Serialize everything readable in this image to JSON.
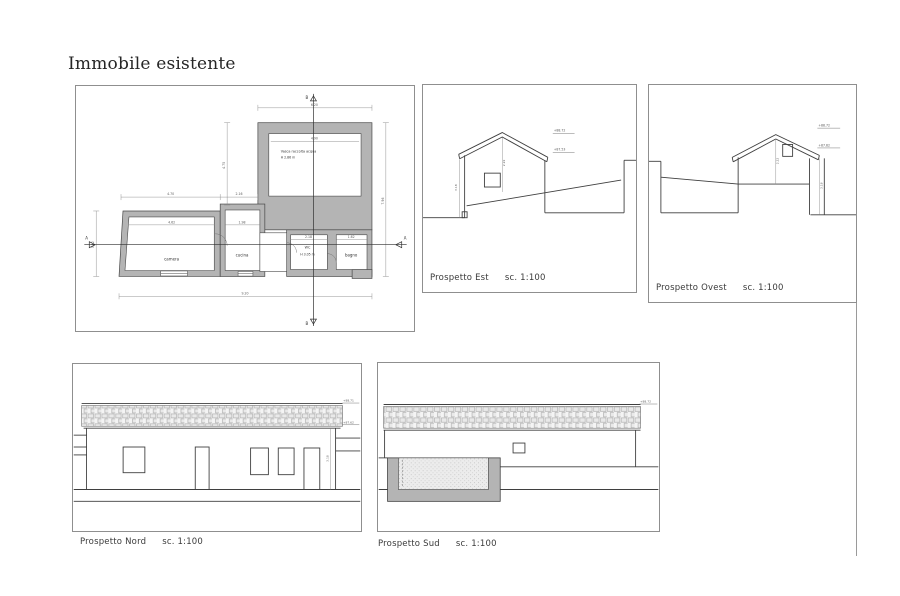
{
  "page": {
    "title": "Immobile esistente"
  },
  "floor_plan": {
    "rooms": {
      "camera": "camera",
      "cucina": "cucina",
      "wc": "WC",
      "wc_height": "H 3.05 m",
      "bagno": "bagno",
      "vasca": "Vasca raccolta acqua",
      "vasca_height": "H 2.86 m"
    },
    "sections": {
      "vertical": "B",
      "horizontal": "A"
    },
    "dims": {
      "vasca_top": "6.20",
      "vasca_inner": "4.90",
      "vasca_left": "4.75",
      "overall_right": "7.96",
      "camera_top": "4.70",
      "cucina_top": "2.16",
      "overall_bottom": "9.20",
      "camera_left": "3.12",
      "camera_inner": "4.62",
      "cucina_inner": "1.98",
      "wc_inner": "2.18",
      "bagno_inner": "1.62"
    }
  },
  "elevations": {
    "est": {
      "name": "Prospetto Est",
      "scale": "sc. 1:100",
      "level_top": "+88.72",
      "level_eave": "+87.53",
      "dim_ridge": "2.22",
      "dim_wall": "3.18"
    },
    "ovest": {
      "name": "Prospetto Ovest",
      "scale": "sc. 1:100",
      "level_top": "+88.72",
      "level_eave": "+87.62",
      "dim_ridge": "2.22",
      "dim_wall": "3.18"
    },
    "nord": {
      "name": "Prospetto Nord",
      "scale": "sc. 1:100",
      "level_top": "+88.71",
      "level_eave": "+87.62",
      "dim_wall": "3.18"
    },
    "sud": {
      "name": "Prospetto Sud",
      "scale": "sc. 1:100",
      "level_top": "+88.72"
    }
  },
  "colors": {
    "wall_fill": "#b4b4b4",
    "line": "#3f3f3f",
    "dim": "#8a8a8a",
    "panel_border": "#8f8f8f"
  }
}
